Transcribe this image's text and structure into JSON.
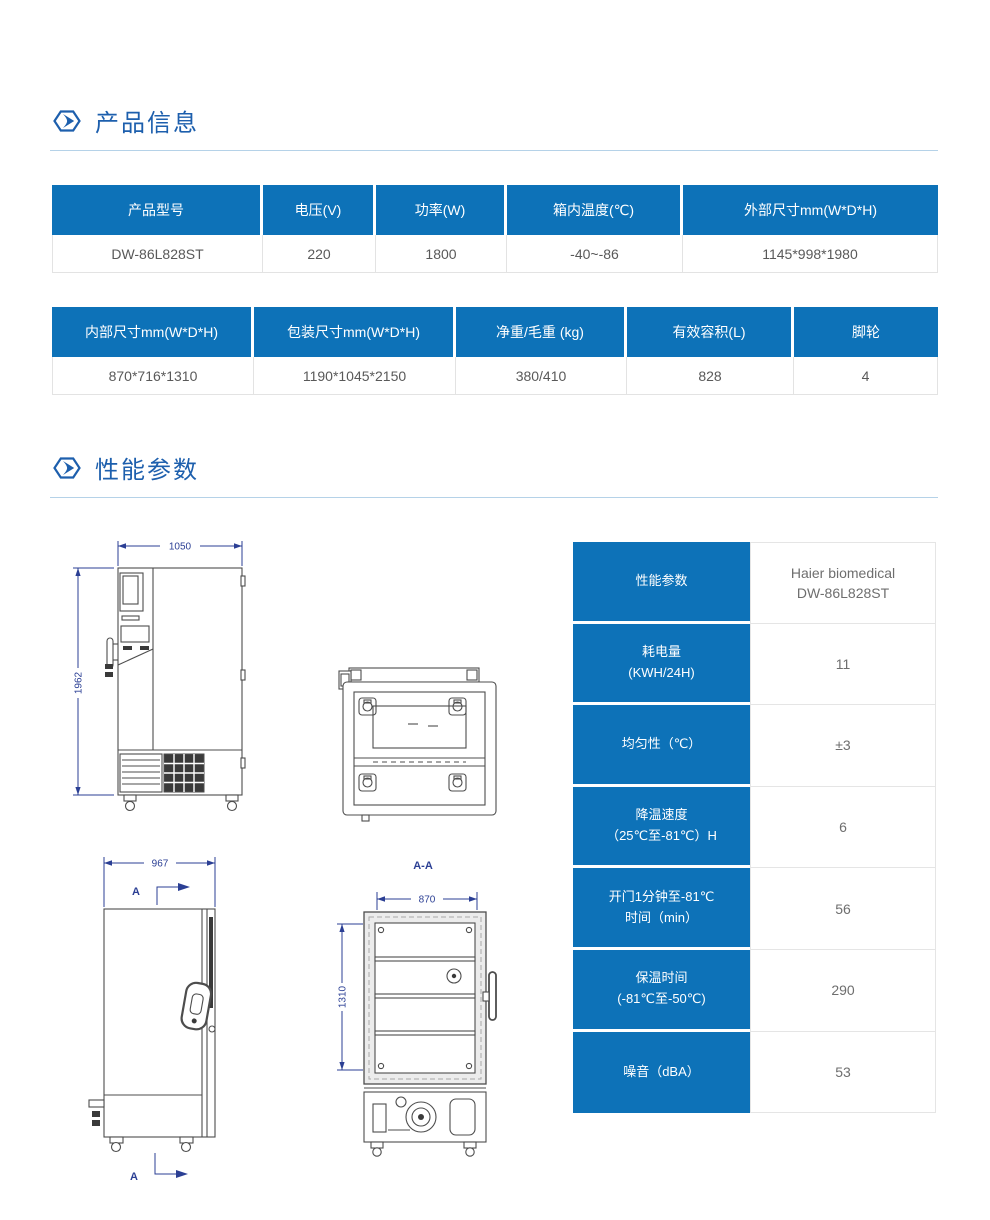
{
  "colors": {
    "table_header_blue": "#0d72b8",
    "title_blue": "#1d5fad",
    "divider_blue": "#b5d2e8",
    "dimension_blue": "#2b3f94"
  },
  "section_product": {
    "title": "产品信息"
  },
  "section_performance": {
    "title": "性能参数"
  },
  "spec_table_1": {
    "headers": [
      "产品型号",
      "电压(V)",
      "功率(W)",
      "箱内温度(℃)",
      "外部尺寸mm(W*D*H)"
    ],
    "row": [
      "DW-86L828ST",
      "220",
      "1800",
      "-40~-86",
      "1145*998*1980"
    ]
  },
  "spec_table_2": {
    "headers": [
      "内部尺寸mm(W*D*H)",
      "包装尺寸mm(W*D*H)",
      "净重/毛重 (kg)",
      "有效容积(L)",
      "脚轮"
    ],
    "row": [
      "870*716*1310",
      "1190*1045*2150",
      "380/410",
      "828",
      "4"
    ]
  },
  "performance_table": {
    "header_label": "性能参数",
    "header_value": "Haier biomedical\nDW-86L828ST",
    "rows": [
      {
        "label": "耗电量\n(KWH/24H)",
        "value": "11"
      },
      {
        "label": "均匀性（℃）",
        "value": "±3"
      },
      {
        "label": "降温速度\n（25℃至-81℃）H",
        "value": "6"
      },
      {
        "label": "开门1分钟至-81℃\n时间（min）",
        "value": "56"
      },
      {
        "label": "保温时间\n(-81℃至-50℃)",
        "value": "290"
      },
      {
        "label": "噪音（dBA）",
        "value": "53"
      }
    ]
  },
  "drawings": {
    "front_view": {
      "width_dim": "1050",
      "height_dim": "1962"
    },
    "side_view": {
      "width_dim": "967",
      "section_marker_top": "A",
      "section_marker_bottom": "A"
    },
    "section_view": {
      "title": "A-A",
      "width_dim": "870",
      "height_dim": "1310"
    }
  }
}
